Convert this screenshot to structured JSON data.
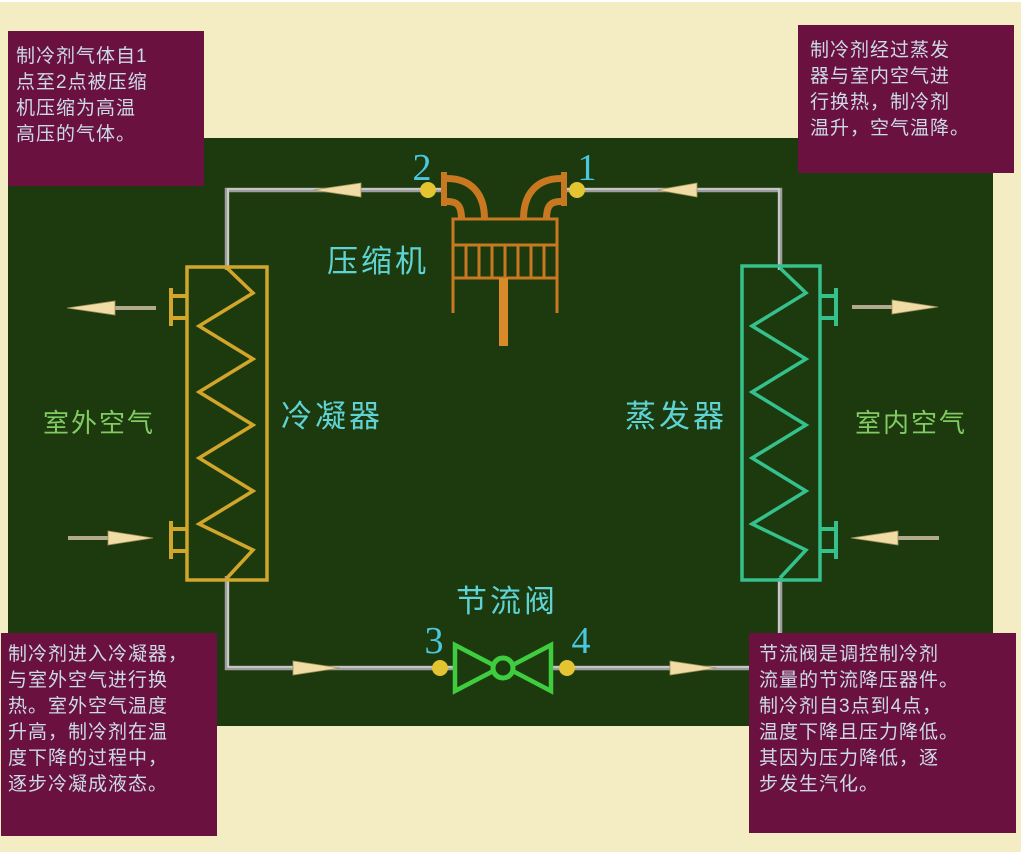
{
  "diagram": {
    "name": "refrigeration-cycle-diagram",
    "component_labels": {
      "compressor": "压缩机",
      "condenser": "冷凝器",
      "evaporator": "蒸发器",
      "throttle_valve": "节流阀",
      "outdoor_air": "室外空气",
      "indoor_air": "室内空气"
    },
    "state_points": {
      "p1": "1",
      "p2": "2",
      "p3": "3",
      "p4": "4"
    },
    "callouts": {
      "compression": {
        "position": "top-left",
        "lines": [
          "制冷剂气体自1",
          "点至2点被压缩",
          "机压缩为高温",
          "高压的气体。"
        ]
      },
      "evaporation": {
        "position": "top-right",
        "lines": [
          "制冷剂经过蒸发",
          "器与室内空气进",
          "行换热，制冷剂",
          "温升，空气温降。"
        ]
      },
      "condensation": {
        "position": "bottom-left",
        "lines": [
          "制冷剂进入冷凝器，",
          "与室外空气进行换",
          "热。室外空气温度",
          "升高，制冷剂在温",
          "度下降的过程中，",
          "逐步冷凝成液态。"
        ]
      },
      "throttling": {
        "position": "bottom-right",
        "lines": [
          "节流阀是调控制冷剂",
          "流量的节流降压器件。",
          "制冷剂自3点到4点，",
          "温度下降且压力降低。",
          "其因为压力降低，逐",
          "步发生汽化。"
        ]
      }
    },
    "colors": {
      "background_cream": "#F4EDC4",
      "panel_green": "#1C3A0E",
      "callout_bg": "#6A1140",
      "callout_text": "#CBDAE8",
      "pipe_gray": "#ADADAD",
      "compressor_orange": "#C87820",
      "condenser_gold": "#D2A62A",
      "evaporator_teal": "#35C08C",
      "valve_green": "#3FCC3F",
      "label_cyan": "#5FD3D3",
      "air_label_green": "#82CB63",
      "digit_cyan": "#49C8E0",
      "dot_yellow": "#E4C430",
      "arrow_cream": "#F0DCA4"
    }
  }
}
